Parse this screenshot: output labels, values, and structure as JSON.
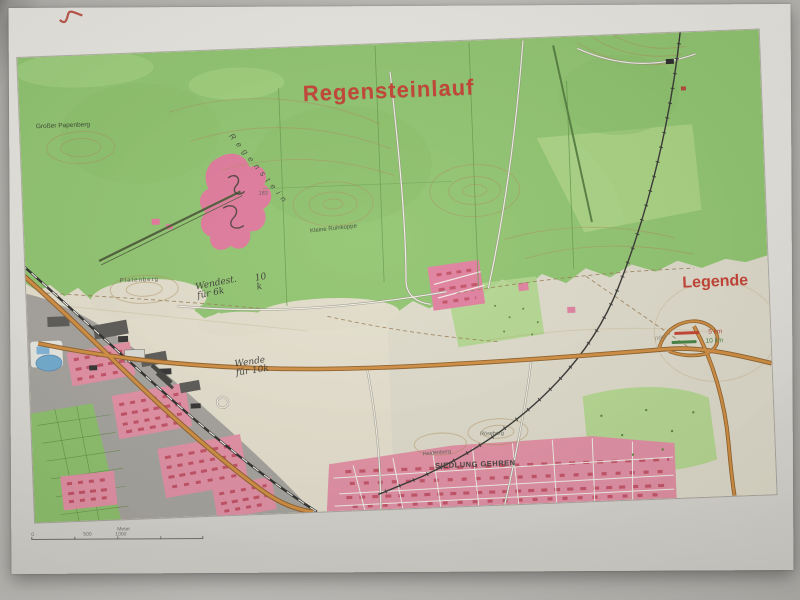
{
  "map": {
    "title": "Regensteinlauf",
    "legend": {
      "title": "Legende",
      "items": [
        {
          "label": "5 km",
          "color": "#c23b2a"
        },
        {
          "label": "10 km",
          "color": "#3f7d3a"
        }
      ],
      "pencil_note": "neu"
    },
    "places": {
      "grosser_papenberg": "Großer Papenberg",
      "regenstein": "Regenstein",
      "elevation": "183",
      "kleine_ruinkoppe": "Kleine Ruinkoppe",
      "platenberg": "Platenberg",
      "heidenberg": "Heidenberg",
      "roeseberg": "Röseberg",
      "siedlung_gehren": "SIEDLUNG GEHREN"
    },
    "handwriting": {
      "note1_line1": "Wendest.",
      "note1_line2": "für 6k",
      "note1_side": "10 k",
      "note2_line1": "Wende",
      "note2_line2": "für 10k"
    },
    "scalebar": {
      "zero": "0",
      "mid": "500",
      "end": "1000",
      "unit": "Meter"
    },
    "colors": {
      "forest_green": "#8cc36a",
      "open_land": "#e4dfcc",
      "urban_pink": "#e28ca1",
      "building_red": "#c24a60",
      "road_orange": "#d08a3a",
      "title_red": "#c13a2b",
      "paper": "#e7e5e0"
    }
  }
}
